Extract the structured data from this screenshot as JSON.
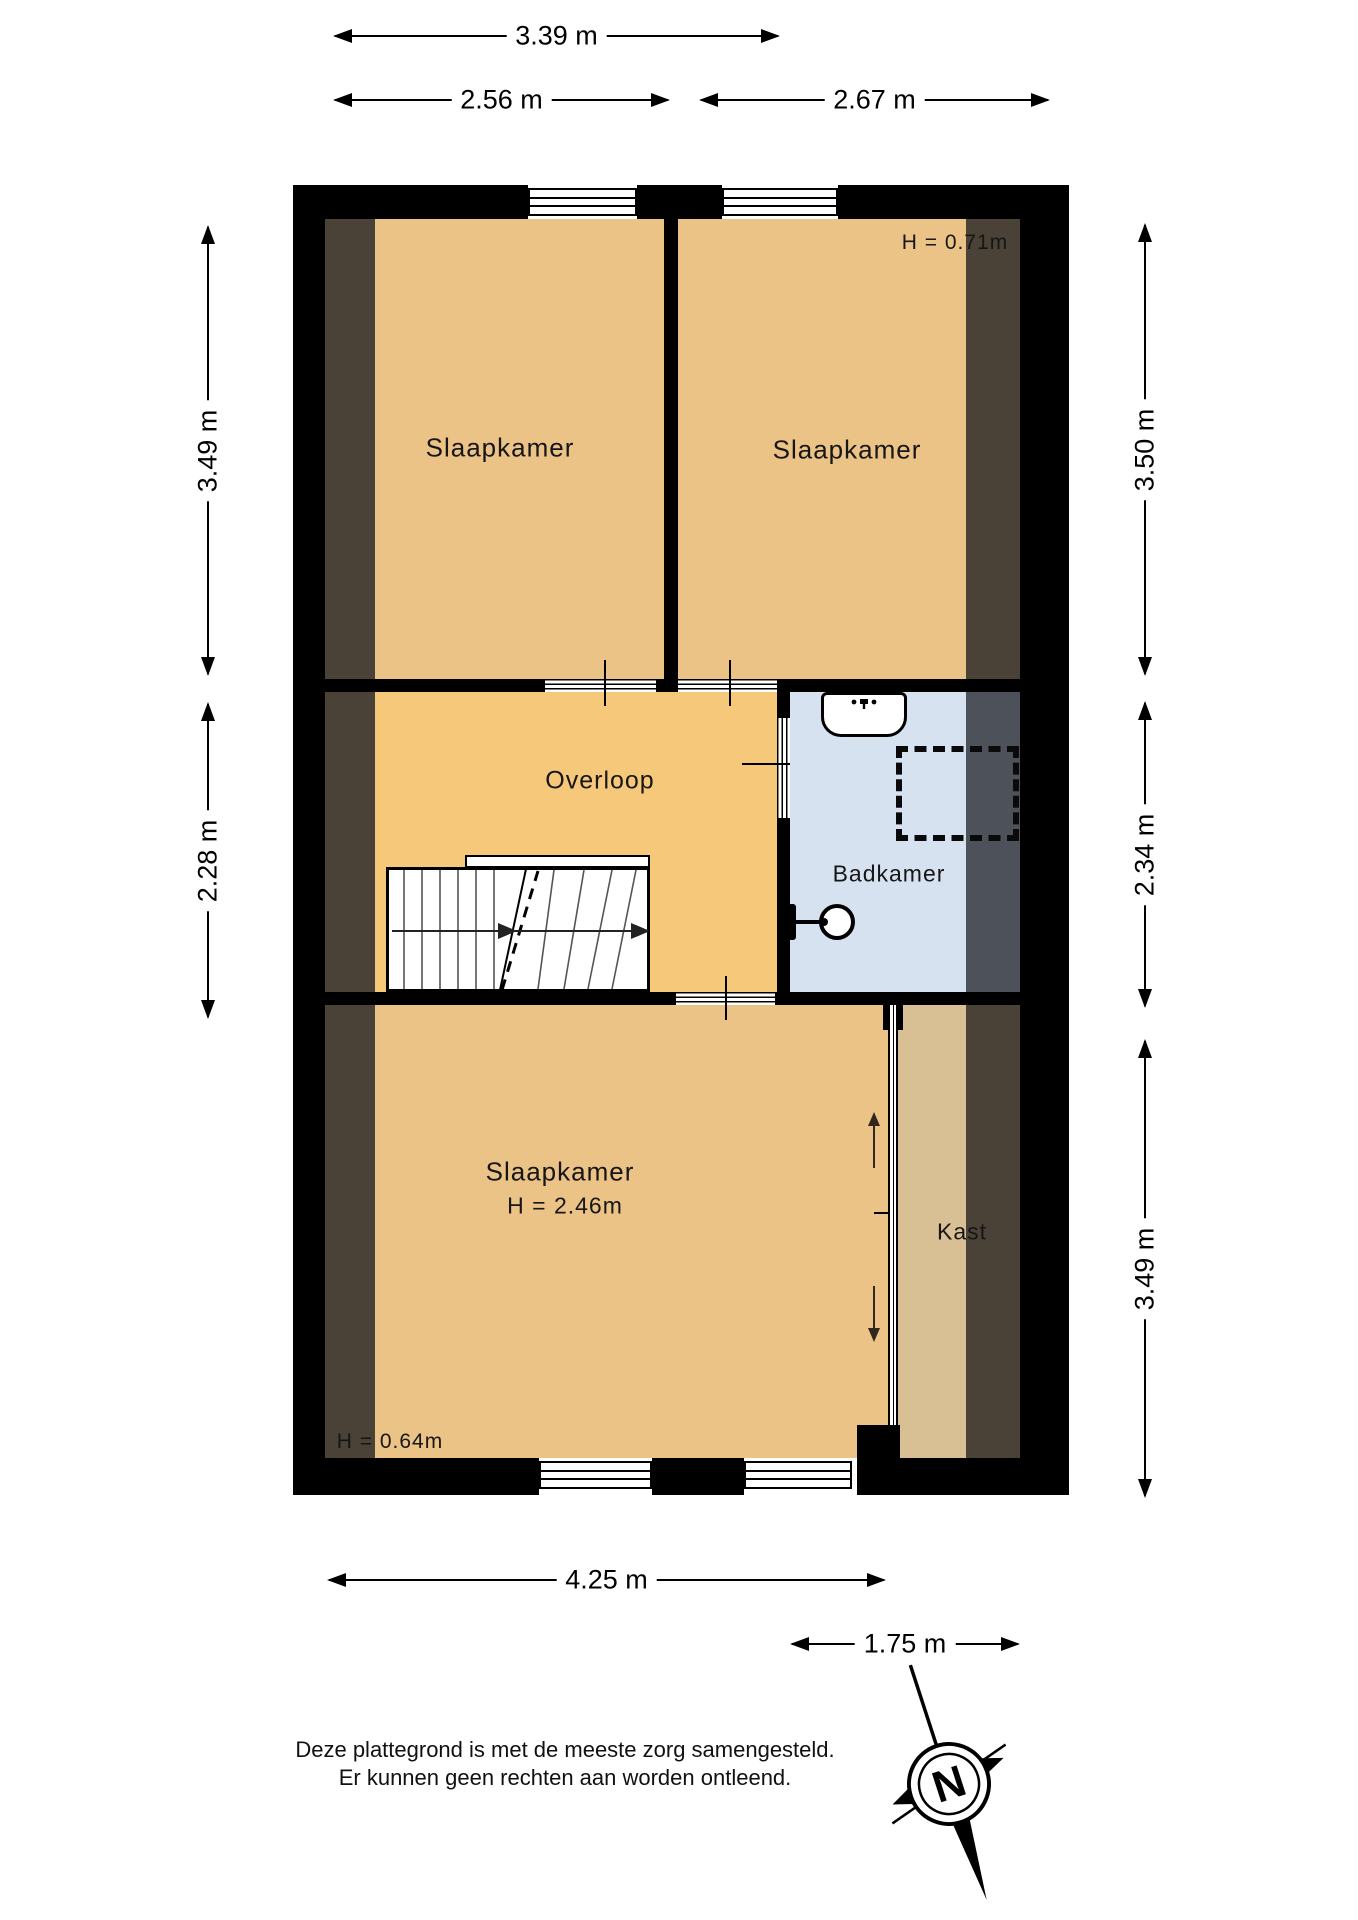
{
  "texts": {
    "dim_top_total": "3.39 m",
    "dim_top_left": "2.56 m",
    "dim_top_right": "2.67 m",
    "dim_left_top": "3.49 m",
    "dim_left_mid": "2.28 m",
    "dim_right_top": "3.50 m",
    "dim_right_mid": "2.34 m",
    "dim_right_bottom": "3.49 m",
    "dim_bottom_main": "4.25 m",
    "dim_bottom_closet": "1.75 m",
    "room_bedroom_top_left": "Slaapkamer",
    "room_bedroom_top_right": "Slaapkamer",
    "room_bedroom_bottom": "Slaapkamer",
    "room_landing": "Overloop",
    "room_bathroom": "Badkamer",
    "room_closet": "Kast",
    "height_top_right": "H = 0.71m",
    "height_bottom_room": "H = 2.46m",
    "height_bottom_left": "H = 0.64m",
    "compass_north": "N",
    "disclaimer_line1": "Deze plattegrond is met de meeste zorg samengesteld.",
    "disclaimer_line2": "Er kunnen geen rechten aan worden ontleend."
  },
  "colors": {
    "wall": "#000000",
    "bedroom_fill": "#ecc387",
    "landing_fill": "#f6c87a",
    "bathroom_fill": "#d7e2f0",
    "closet_fill": "#d9bf94",
    "attic_strip": "#4a4237",
    "bathroom_strip": "#4d525a"
  }
}
